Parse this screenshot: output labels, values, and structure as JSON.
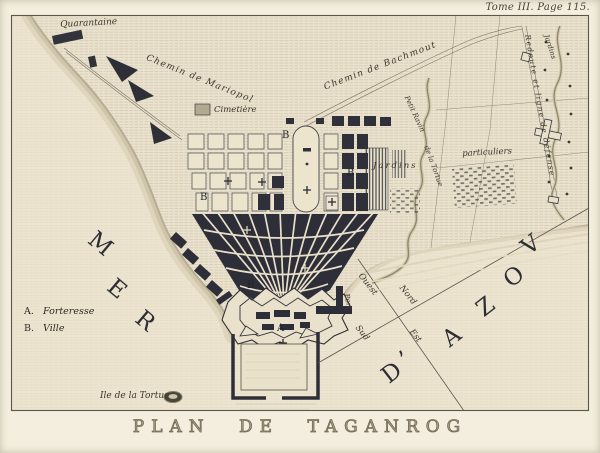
{
  "page_ref": "Tome III. Page 115.",
  "title": "PLAN DE TAGANROG",
  "legend": {
    "items": [
      {
        "key": "A.",
        "label": "Forteresse"
      },
      {
        "key": "B.",
        "label": "Ville"
      }
    ]
  },
  "labels": {
    "quarantaine": "Quarantaine",
    "chemin_mariopol": "Chemin de Mariopol",
    "chemin_bachmout": "Chemin de Bachmout",
    "cimetiere": "Cimetière",
    "jardins": "Jardins",
    "particuliers": "particuliers",
    "ravin_petit": "Petit Ravin",
    "ravin_tortue": "de la Tortue",
    "redoute": "Redoute et ligne de défense",
    "jardins_est": "Jardins",
    "port": "Port",
    "ile_tortue": "Ile de la Tortue"
  },
  "markers": {
    "fortress": "A",
    "ville": "B"
  },
  "sea": {
    "mer": [
      "M",
      "E",
      "R"
    ],
    "azov": [
      "D",
      "’",
      "A",
      "Z",
      "O",
      "V"
    ]
  },
  "compass": {
    "ouest": "Ouest",
    "nord": "Nord",
    "sud": "Sud",
    "est": "Est"
  },
  "colors": {
    "paper": "#f3eedd",
    "map_paper": "#ece4cf",
    "ink": "#2e2e38",
    "shore": "#c9bfa4"
  }
}
